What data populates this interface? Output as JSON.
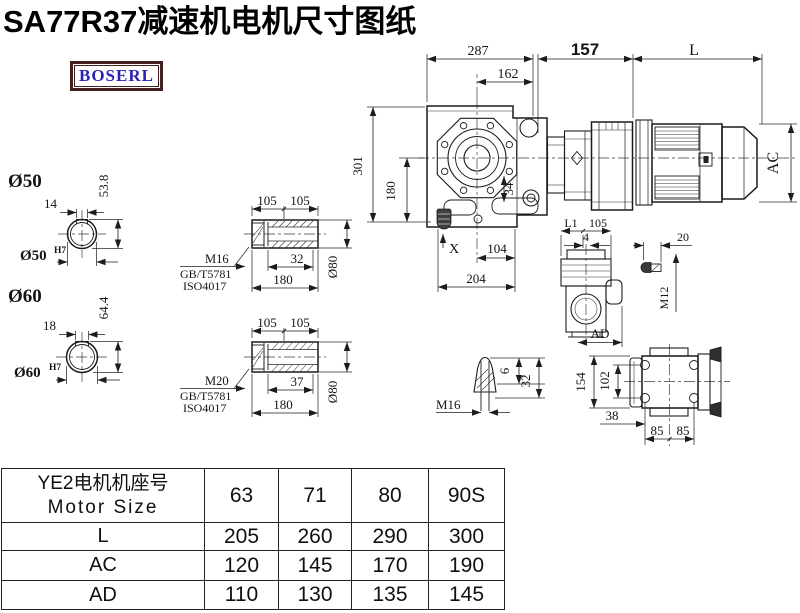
{
  "title": "SA77R37减速机电机尺寸图纸",
  "logo": {
    "text": "BOSERL"
  },
  "drawing": {
    "main": {
      "d287": "287",
      "d162": "162",
      "d157": "157",
      "dL": "L",
      "d301": "301",
      "d180": "180",
      "dAC": "AC",
      "d34": "34",
      "dX": "X",
      "d104": "104",
      "d204": "204"
    },
    "section50": {
      "label": "Ø50",
      "key_w": "14",
      "key_h": "53.8",
      "bore": "Ø50",
      "tol": "H7"
    },
    "section60": {
      "label": "Ø60",
      "key_w": "18",
      "key_h": "64.4",
      "bore": "Ø60",
      "tol": "H7"
    },
    "hollow1": {
      "l1": "105",
      "l2": "105",
      "key": "32",
      "total": "180",
      "od": "Ø80",
      "bolt": "M16",
      "std": "GB/T5781",
      "iso": "ISO4017"
    },
    "hollow2": {
      "l1": "105",
      "l2": "105",
      "key": "37",
      "total": "180",
      "od": "Ø80",
      "bolt": "M20",
      "std": "GB/T5781",
      "iso": "ISO4017"
    },
    "plug": {
      "thread": "M16",
      "tip": "6",
      "len": "32"
    },
    "side": {
      "l1": "L1",
      "p105": "105",
      "p4": "4",
      "ad": "AD"
    },
    "bolt": {
      "len": "20",
      "thread": "M12"
    },
    "top": {
      "h154": "154",
      "h102": "102",
      "d38": "38",
      "d85a": "85",
      "d85b": "85"
    }
  },
  "table": {
    "header_cn": "YE2电机机座号",
    "header_en": "Motor Size",
    "sizes": [
      "63",
      "71",
      "80",
      "90S"
    ],
    "rows": [
      {
        "label": "L",
        "values": [
          "205",
          "260",
          "290",
          "300"
        ]
      },
      {
        "label": "AC",
        "values": [
          "120",
          "145",
          "170",
          "190"
        ]
      },
      {
        "label": "AD",
        "values": [
          "110",
          "130",
          "135",
          "145"
        ]
      }
    ]
  }
}
